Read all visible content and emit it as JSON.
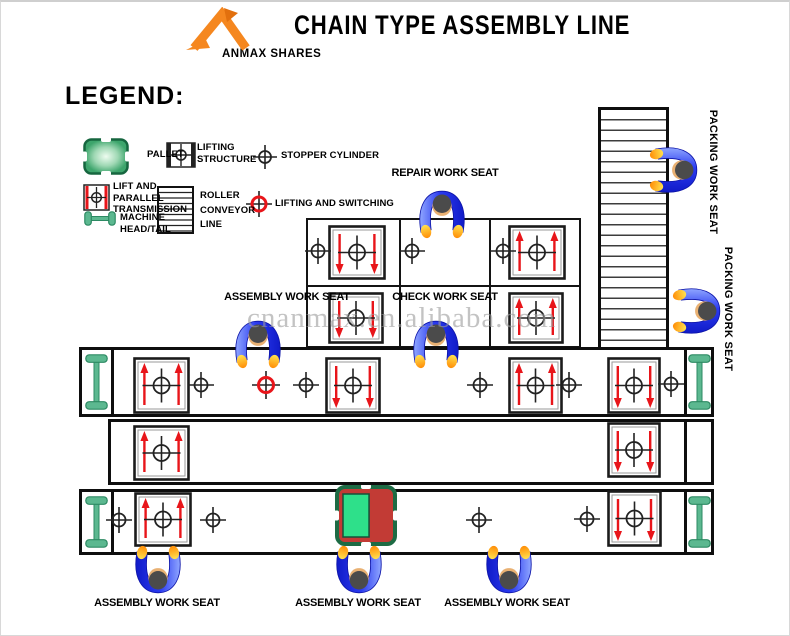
{
  "header": {
    "title": "CHAIN TYPE ASSEMBLY LINE",
    "logo_text": "ANMAX SHARES"
  },
  "legend": {
    "heading": "LEGEND:",
    "pallet": "PALLET",
    "lifting_structure": "LIFTING\nSTRUCTURE",
    "stopper_cylinder": "STOPPER CYLINDER",
    "lift_parallel": "LIFT AND\nPARALLEL\nTRANSMISSION",
    "roller_conveyor": "ROLLER\nCONVEYOR\nLINE",
    "lifting_switching": "LIFTING AND SWITCHING",
    "machine_head_tail": "MACHINE\nHEAD/TAIL"
  },
  "stations": {
    "repair": "REPAIR WORK SEAT",
    "assembly_top": "ASSEMBLY WORK SEAT",
    "check": "CHECK WORK SEAT",
    "packing_1": "PACKING WORK SEAT",
    "packing_2": "PACKING WORK SEAT",
    "assembly_bottom_1": "ASSEMBLY WORK SEAT",
    "assembly_bottom_2": "ASSEMBLY WORK SEAT",
    "assembly_bottom_3": "ASSEMBLY WORK SEAT"
  },
  "watermark": "cnanmax.en.alibaba.com",
  "colors": {
    "accent_orange": "#f5871f",
    "arrow_red": "#e8151a",
    "machine_green": "#5cb890",
    "machine_green_dark": "#2d8a63",
    "pallet_green": "#3da56c",
    "special_green": "#2ee08a",
    "special_red": "#c23b35",
    "worker_blue": "#2b3bf0",
    "watermark_gray": "#9c9c9c"
  },
  "diagram": {
    "pallets": [
      {
        "x": 327,
        "y": 223,
        "w": 58,
        "h": 55,
        "dir": "down"
      },
      {
        "x": 507,
        "y": 223,
        "w": 58,
        "h": 55,
        "dir": "up"
      },
      {
        "x": 327,
        "y": 290,
        "w": 56,
        "h": 52,
        "dir": "down"
      },
      {
        "x": 507,
        "y": 290,
        "w": 56,
        "h": 52,
        "dir": "up"
      },
      {
        "x": 132,
        "y": 355,
        "w": 57,
        "h": 57,
        "dir": "up"
      },
      {
        "x": 324,
        "y": 355,
        "w": 56,
        "h": 57,
        "dir": "down"
      },
      {
        "x": 507,
        "y": 355,
        "w": 55,
        "h": 57,
        "dir": "up"
      },
      {
        "x": 606,
        "y": 355,
        "w": 54,
        "h": 57,
        "dir": "down"
      },
      {
        "x": 132,
        "y": 423,
        "w": 57,
        "h": 56,
        "dir": "up"
      },
      {
        "x": 606,
        "y": 420,
        "w": 54,
        "h": 56,
        "dir": "down"
      },
      {
        "x": 133,
        "y": 490,
        "w": 58,
        "h": 55,
        "dir": "up"
      },
      {
        "x": 606,
        "y": 488,
        "w": 55,
        "h": 57,
        "dir": "down"
      }
    ],
    "special_pallet": {
      "x": 334,
      "y": 483,
      "w": 62,
      "h": 61
    },
    "stoppers": [
      {
        "x": 317,
        "y": 249
      },
      {
        "x": 411,
        "y": 249
      },
      {
        "x": 502,
        "y": 249
      },
      {
        "x": 200,
        "y": 383
      },
      {
        "x": 305,
        "y": 383
      },
      {
        "x": 479,
        "y": 383
      },
      {
        "x": 568,
        "y": 383
      },
      {
        "x": 670,
        "y": 382
      },
      {
        "x": 118,
        "y": 518
      },
      {
        "x": 212,
        "y": 518
      },
      {
        "x": 478,
        "y": 518
      },
      {
        "x": 586,
        "y": 517
      }
    ],
    "switches": [
      {
        "x": 265,
        "y": 383
      }
    ],
    "machines": [
      {
        "x": 84,
        "y": 352,
        "w": 23,
        "h": 56,
        "o": "v"
      },
      {
        "x": 687,
        "y": 352,
        "w": 23,
        "h": 56,
        "o": "v"
      },
      {
        "x": 84,
        "y": 494,
        "w": 23,
        "h": 52,
        "o": "v"
      },
      {
        "x": 687,
        "y": 494,
        "w": 23,
        "h": 52,
        "o": "v"
      }
    ],
    "workers": [
      {
        "x": 441,
        "y": 211,
        "facing": "down",
        "station": "repair"
      },
      {
        "x": 257,
        "y": 341,
        "facing": "down",
        "station": "assembly-top"
      },
      {
        "x": 435,
        "y": 341,
        "facing": "down",
        "station": "check"
      },
      {
        "x": 674,
        "y": 168,
        "facing": "left",
        "station": "packing-1"
      },
      {
        "x": 697,
        "y": 309,
        "facing": "left",
        "station": "packing-2"
      },
      {
        "x": 157,
        "y": 569,
        "facing": "up",
        "station": "assembly-bottom-1"
      },
      {
        "x": 358,
        "y": 569,
        "facing": "up",
        "station": "assembly-bottom-2"
      },
      {
        "x": 508,
        "y": 569,
        "facing": "up",
        "station": "assembly-bottom-3"
      }
    ]
  }
}
